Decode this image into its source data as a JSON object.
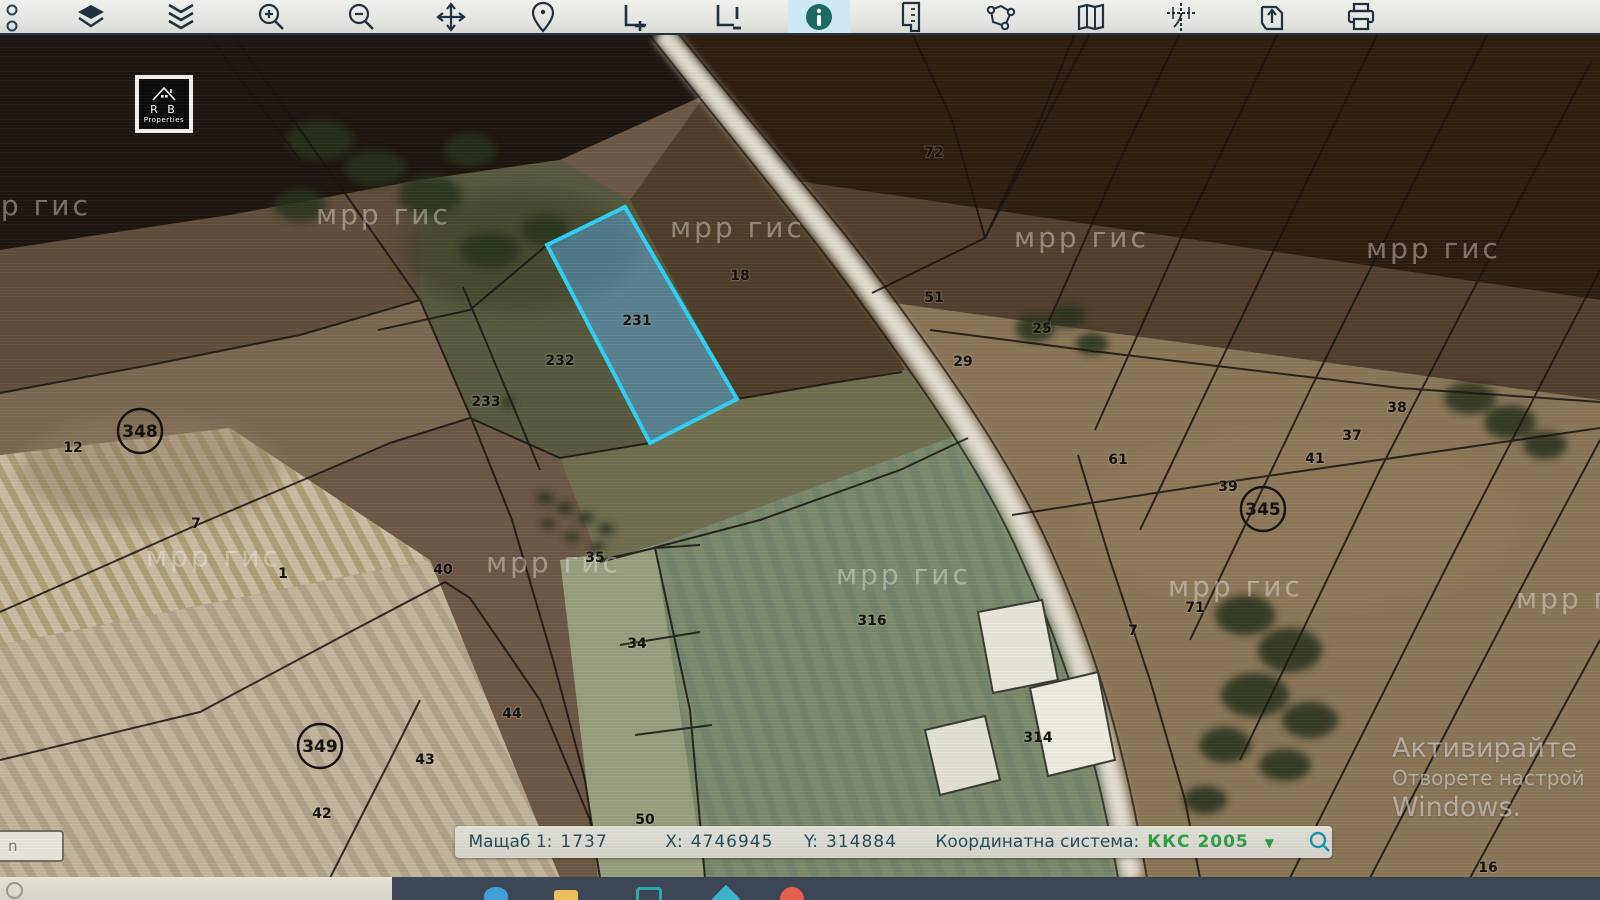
{
  "toolbar": {
    "items": [
      {
        "name": "overflow-dots-icon"
      },
      {
        "name": "layers-stack-icon"
      },
      {
        "name": "collapse-chevrons-icon"
      },
      {
        "name": "zoom-in-icon"
      },
      {
        "name": "zoom-out-icon"
      },
      {
        "name": "pan-icon"
      },
      {
        "name": "location-pin-icon"
      },
      {
        "name": "extent-add-icon"
      },
      {
        "name": "extent-alert-icon"
      },
      {
        "name": "info-icon",
        "active": true
      },
      {
        "name": "ruler-page-icon"
      },
      {
        "name": "polygon-nodes-icon"
      },
      {
        "name": "map-icon"
      },
      {
        "name": "coordinates-icon"
      },
      {
        "name": "export-icon"
      },
      {
        "name": "print-icon"
      }
    ]
  },
  "map": {
    "highlighted_parcel": "231",
    "watermark": {
      "text": "мрр гис",
      "positions": [
        {
          "x": -44,
          "y": 215
        },
        {
          "x": 316,
          "y": 224
        },
        {
          "x": 670,
          "y": 237
        },
        {
          "x": 1014,
          "y": 247
        },
        {
          "x": 1366,
          "y": 258
        },
        {
          "x": 146,
          "y": 566
        },
        {
          "x": 486,
          "y": 572
        },
        {
          "x": 836,
          "y": 584
        },
        {
          "x": 1168,
          "y": 596
        },
        {
          "x": 1516,
          "y": 608
        }
      ]
    },
    "parcel_labels": [
      {
        "text": "12",
        "x": 73,
        "y": 452
      },
      {
        "text": "7",
        "x": 196,
        "y": 528
      },
      {
        "text": "1",
        "x": 283,
        "y": 578
      },
      {
        "text": "233",
        "x": 486,
        "y": 406
      },
      {
        "text": "232",
        "x": 560,
        "y": 365
      },
      {
        "text": "231",
        "x": 637,
        "y": 325
      },
      {
        "text": "18",
        "x": 740,
        "y": 280
      },
      {
        "text": "72",
        "x": 934,
        "y": 157
      },
      {
        "text": "51",
        "x": 934,
        "y": 302
      },
      {
        "text": "29",
        "x": 963,
        "y": 366
      },
      {
        "text": "25",
        "x": 1042,
        "y": 333
      },
      {
        "text": "61",
        "x": 1118,
        "y": 464
      },
      {
        "text": "39",
        "x": 1228,
        "y": 491
      },
      {
        "text": "41",
        "x": 1315,
        "y": 463
      },
      {
        "text": "37",
        "x": 1352,
        "y": 440
      },
      {
        "text": "38",
        "x": 1397,
        "y": 412
      },
      {
        "text": "71",
        "x": 1195,
        "y": 612
      },
      {
        "text": "7",
        "x": 1133,
        "y": 635
      },
      {
        "text": "316",
        "x": 872,
        "y": 625
      },
      {
        "text": "314",
        "x": 1038,
        "y": 742
      },
      {
        "text": "40",
        "x": 443,
        "y": 574
      },
      {
        "text": "35",
        "x": 595,
        "y": 562
      },
      {
        "text": "34",
        "x": 637,
        "y": 648
      },
      {
        "text": "44",
        "x": 512,
        "y": 718
      },
      {
        "text": "43",
        "x": 425,
        "y": 764
      },
      {
        "text": "42",
        "x": 322,
        "y": 818
      },
      {
        "text": "50",
        "x": 645,
        "y": 824
      },
      {
        "text": "16",
        "x": 1488,
        "y": 872
      }
    ],
    "circled_labels": [
      {
        "text": "348",
        "x": 140,
        "y": 437
      },
      {
        "text": "345",
        "x": 1263,
        "y": 515
      },
      {
        "text": "349",
        "x": 320,
        "y": 752
      }
    ],
    "logo": {
      "line1": "R B",
      "line2": "Properties"
    },
    "activation": {
      "line1": "Активирайте",
      "line2": "Отворете настрой",
      "line3": "Windows."
    }
  },
  "statusbar": {
    "scale_label": "Мащаб 1:",
    "scale_value": "1737",
    "x_label": "X:",
    "x_value": "4746945",
    "y_label": "Y:",
    "y_value": "314884",
    "crs_label": "Координатна система:",
    "crs_value": "ККС 2005"
  },
  "tooltip": {
    "text": "n"
  },
  "colors": {
    "highlight_stroke": "#2fd0f5",
    "highlight_fill": "rgba(90,170,230,0.5)",
    "crs_green": "#2f9e44",
    "toolbar_icon": "#2c3e50",
    "info_teal": "#1d6a62",
    "search_teal": "#1f8fa8"
  }
}
